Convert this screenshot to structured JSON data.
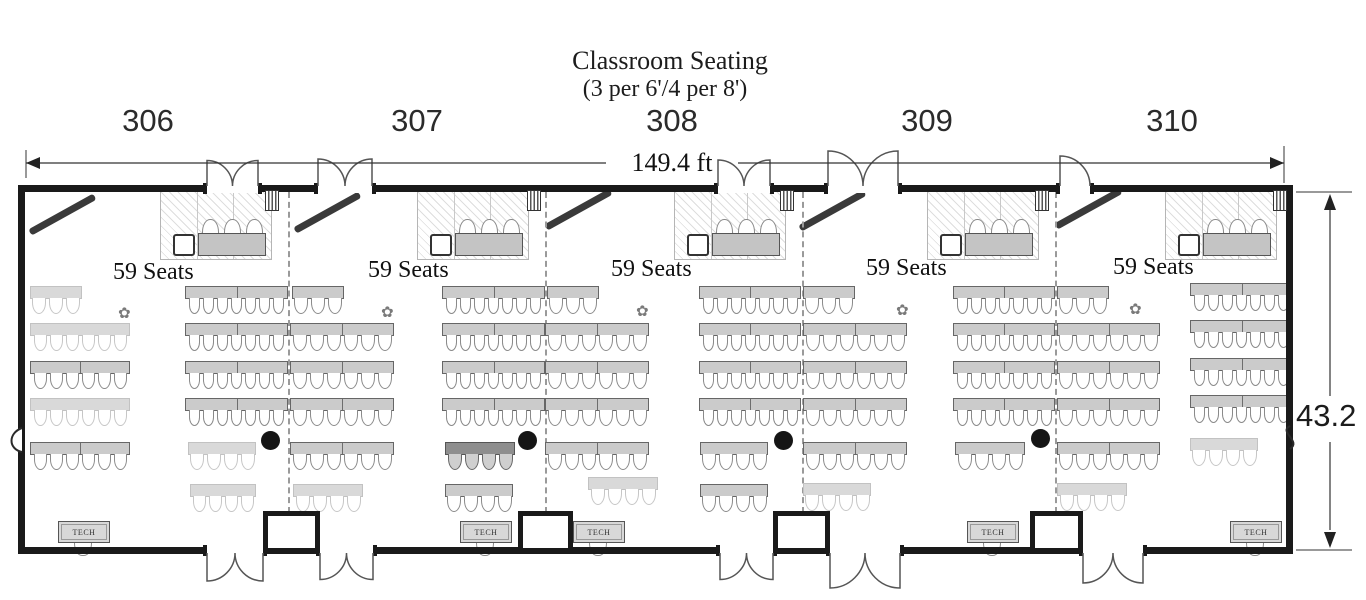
{
  "title": {
    "line1": "Classroom Seating",
    "line2": "(3 per 6'/4 per 8')"
  },
  "dimensions": {
    "width_label": "149.4 ft",
    "height_label": "43.2"
  },
  "tech_label": "TECH",
  "icons": {
    "sprinkler": "✿"
  },
  "colors": {
    "wall": "#1a1a1a",
    "table": "#cbcbcb",
    "table_dark": "#8e8e8e",
    "table_light": "#d9d9d9",
    "screen": "#3a3a3a",
    "dot": "#151515"
  },
  "rooms": [
    {
      "number": "306",
      "seats_label": "59 Seats",
      "number_x": 148,
      "seats_x": 113,
      "seats_y": 259
    },
    {
      "number": "307",
      "seats_label": "59 Seats",
      "number_x": 417,
      "seats_x": 368,
      "seats_y": 257
    },
    {
      "number": "308",
      "seats_label": "59 Seats",
      "number_x": 672,
      "seats_x": 611,
      "seats_y": 256
    },
    {
      "number": "309",
      "seats_label": "59 Seats",
      "number_x": 927,
      "seats_x": 866,
      "seats_y": 255
    },
    {
      "number": "310",
      "seats_label": "59 Seats",
      "number_x": 1172,
      "seats_x": 1113,
      "seats_y": 254
    }
  ],
  "plan": {
    "walls": {
      "left": 18,
      "top": 185,
      "right": 1286,
      "bottom": 547,
      "thickness": 7
    },
    "top_doors": [
      [
        207,
        258
      ],
      [
        318,
        372
      ],
      [
        718,
        770
      ],
      [
        828,
        898
      ],
      [
        1060,
        1090
      ]
    ],
    "bottom_doors": [
      [
        207,
        263
      ],
      [
        320,
        373
      ],
      [
        720,
        773
      ],
      [
        830,
        900
      ],
      [
        1083,
        1143
      ]
    ],
    "bumpouts": [
      [
        263,
        320
      ],
      [
        518,
        573
      ],
      [
        773,
        830
      ],
      [
        1030,
        1083
      ]
    ],
    "dividers": [
      288,
      545,
      802,
      1055
    ],
    "vents": [
      265,
      527,
      780,
      1035,
      1273
    ],
    "screens": [
      [
        30,
        229
      ],
      [
        295,
        227
      ],
      [
        546,
        224
      ],
      [
        800,
        225
      ],
      [
        1056,
        223
      ]
    ],
    "boards": [
      160,
      417,
      674,
      927,
      1165
    ],
    "instr_tables": [
      198,
      455,
      712,
      965,
      1203
    ],
    "carts": [
      173,
      430,
      687,
      940,
      1178
    ],
    "tech_stations": [
      58,
      460,
      573,
      967,
      1230
    ],
    "dots": [
      [
        270,
        440
      ],
      [
        527,
        440
      ],
      [
        783,
        440
      ],
      [
        1040,
        438
      ]
    ],
    "flowers": [
      [
        118,
        306
      ],
      [
        381,
        305
      ],
      [
        636,
        304
      ],
      [
        896,
        303
      ],
      [
        1129,
        302
      ]
    ],
    "rows": [
      {
        "x": 30,
        "y": 286,
        "w": 52,
        "n": 3,
        "seg": 1,
        "shade": "l"
      },
      {
        "x": 30,
        "y": 323,
        "w": 100,
        "n": 6,
        "seg": 1,
        "shade": "l"
      },
      {
        "x": 30,
        "y": 361,
        "w": 100,
        "n": 6,
        "seg": 2,
        "shade": "n"
      },
      {
        "x": 30,
        "y": 398,
        "w": 100,
        "n": 6,
        "seg": 1,
        "shade": "l"
      },
      {
        "x": 30,
        "y": 442,
        "w": 100,
        "n": 6,
        "seg": 2,
        "shade": "n"
      },
      {
        "x": 185,
        "y": 286,
        "w": 103,
        "n": 7,
        "seg": 2,
        "shade": "n"
      },
      {
        "x": 185,
        "y": 323,
        "w": 103,
        "n": 7,
        "seg": 2,
        "shade": "n"
      },
      {
        "x": 185,
        "y": 361,
        "w": 103,
        "n": 7,
        "seg": 2,
        "shade": "n"
      },
      {
        "x": 185,
        "y": 398,
        "w": 103,
        "n": 7,
        "seg": 2,
        "shade": "n"
      },
      {
        "x": 188,
        "y": 442,
        "w": 68,
        "n": 4,
        "seg": 1,
        "shade": "l"
      },
      {
        "x": 190,
        "y": 484,
        "w": 66,
        "n": 4,
        "seg": 1,
        "shade": "l"
      },
      {
        "x": 292,
        "y": 286,
        "w": 52,
        "n": 3,
        "seg": 1,
        "shade": "n"
      },
      {
        "x": 290,
        "y": 323,
        "w": 104,
        "n": 6,
        "seg": 2,
        "shade": "n"
      },
      {
        "x": 290,
        "y": 361,
        "w": 104,
        "n": 6,
        "seg": 2,
        "shade": "n"
      },
      {
        "x": 290,
        "y": 398,
        "w": 104,
        "n": 6,
        "seg": 2,
        "shade": "n"
      },
      {
        "x": 290,
        "y": 442,
        "w": 104,
        "n": 6,
        "seg": 2,
        "shade": "n"
      },
      {
        "x": 293,
        "y": 484,
        "w": 70,
        "n": 4,
        "seg": 1,
        "shade": "l"
      },
      {
        "x": 442,
        "y": 286,
        "w": 103,
        "n": 7,
        "seg": 2,
        "shade": "n"
      },
      {
        "x": 442,
        "y": 323,
        "w": 103,
        "n": 7,
        "seg": 2,
        "shade": "n"
      },
      {
        "x": 442,
        "y": 361,
        "w": 103,
        "n": 7,
        "seg": 2,
        "shade": "n"
      },
      {
        "x": 442,
        "y": 398,
        "w": 103,
        "n": 7,
        "seg": 2,
        "shade": "n"
      },
      {
        "x": 445,
        "y": 442,
        "w": 70,
        "n": 4,
        "seg": 1,
        "shade": "d"
      },
      {
        "x": 445,
        "y": 484,
        "w": 68,
        "n": 4,
        "seg": 1,
        "shade": "n"
      },
      {
        "x": 547,
        "y": 286,
        "w": 52,
        "n": 3,
        "seg": 1,
        "shade": "n"
      },
      {
        "x": 545,
        "y": 323,
        "w": 104,
        "n": 6,
        "seg": 2,
        "shade": "n"
      },
      {
        "x": 545,
        "y": 361,
        "w": 104,
        "n": 6,
        "seg": 2,
        "shade": "n"
      },
      {
        "x": 545,
        "y": 398,
        "w": 104,
        "n": 6,
        "seg": 2,
        "shade": "n"
      },
      {
        "x": 545,
        "y": 442,
        "w": 104,
        "n": 6,
        "seg": 2,
        "shade": "n"
      },
      {
        "x": 588,
        "y": 477,
        "w": 70,
        "n": 4,
        "seg": 1,
        "shade": "l"
      },
      {
        "x": 699,
        "y": 286,
        "w": 102,
        "n": 7,
        "seg": 2,
        "shade": "n"
      },
      {
        "x": 699,
        "y": 323,
        "w": 102,
        "n": 7,
        "seg": 2,
        "shade": "n"
      },
      {
        "x": 699,
        "y": 361,
        "w": 102,
        "n": 7,
        "seg": 2,
        "shade": "n"
      },
      {
        "x": 699,
        "y": 398,
        "w": 102,
        "n": 7,
        "seg": 2,
        "shade": "n"
      },
      {
        "x": 700,
        "y": 442,
        "w": 68,
        "n": 4,
        "seg": 1,
        "shade": "n"
      },
      {
        "x": 700,
        "y": 484,
        "w": 68,
        "n": 4,
        "seg": 1,
        "shade": "n"
      },
      {
        "x": 803,
        "y": 286,
        "w": 52,
        "n": 3,
        "seg": 1,
        "shade": "n"
      },
      {
        "x": 803,
        "y": 323,
        "w": 104,
        "n": 6,
        "seg": 2,
        "shade": "n"
      },
      {
        "x": 803,
        "y": 361,
        "w": 104,
        "n": 6,
        "seg": 2,
        "shade": "n"
      },
      {
        "x": 803,
        "y": 398,
        "w": 104,
        "n": 6,
        "seg": 2,
        "shade": "n"
      },
      {
        "x": 803,
        "y": 442,
        "w": 104,
        "n": 6,
        "seg": 2,
        "shade": "n"
      },
      {
        "x": 803,
        "y": 483,
        "w": 68,
        "n": 4,
        "seg": 1,
        "shade": "l"
      },
      {
        "x": 953,
        "y": 286,
        "w": 102,
        "n": 7,
        "seg": 2,
        "shade": "n"
      },
      {
        "x": 953,
        "y": 323,
        "w": 102,
        "n": 7,
        "seg": 2,
        "shade": "n"
      },
      {
        "x": 953,
        "y": 361,
        "w": 102,
        "n": 7,
        "seg": 2,
        "shade": "n"
      },
      {
        "x": 953,
        "y": 398,
        "w": 102,
        "n": 7,
        "seg": 2,
        "shade": "n"
      },
      {
        "x": 955,
        "y": 442,
        "w": 70,
        "n": 4,
        "seg": 1,
        "shade": "n"
      },
      {
        "x": 1057,
        "y": 286,
        "w": 52,
        "n": 3,
        "seg": 1,
        "shade": "n"
      },
      {
        "x": 1057,
        "y": 323,
        "w": 103,
        "n": 6,
        "seg": 2,
        "shade": "n"
      },
      {
        "x": 1057,
        "y": 361,
        "w": 103,
        "n": 6,
        "seg": 2,
        "shade": "n"
      },
      {
        "x": 1057,
        "y": 398,
        "w": 103,
        "n": 6,
        "seg": 2,
        "shade": "n"
      },
      {
        "x": 1057,
        "y": 442,
        "w": 103,
        "n": 6,
        "seg": 2,
        "shade": "n"
      },
      {
        "x": 1057,
        "y": 483,
        "w": 70,
        "n": 4,
        "seg": 1,
        "shade": "l"
      },
      {
        "x": 1190,
        "y": 283,
        "w": 103,
        "n": 7,
        "seg": 2,
        "shade": "n"
      },
      {
        "x": 1190,
        "y": 320,
        "w": 103,
        "n": 7,
        "seg": 2,
        "shade": "n"
      },
      {
        "x": 1190,
        "y": 358,
        "w": 103,
        "n": 7,
        "seg": 2,
        "shade": "n"
      },
      {
        "x": 1190,
        "y": 395,
        "w": 103,
        "n": 7,
        "seg": 2,
        "shade": "n"
      },
      {
        "x": 1190,
        "y": 438,
        "w": 68,
        "n": 4,
        "seg": 1,
        "shade": "l"
      }
    ]
  }
}
